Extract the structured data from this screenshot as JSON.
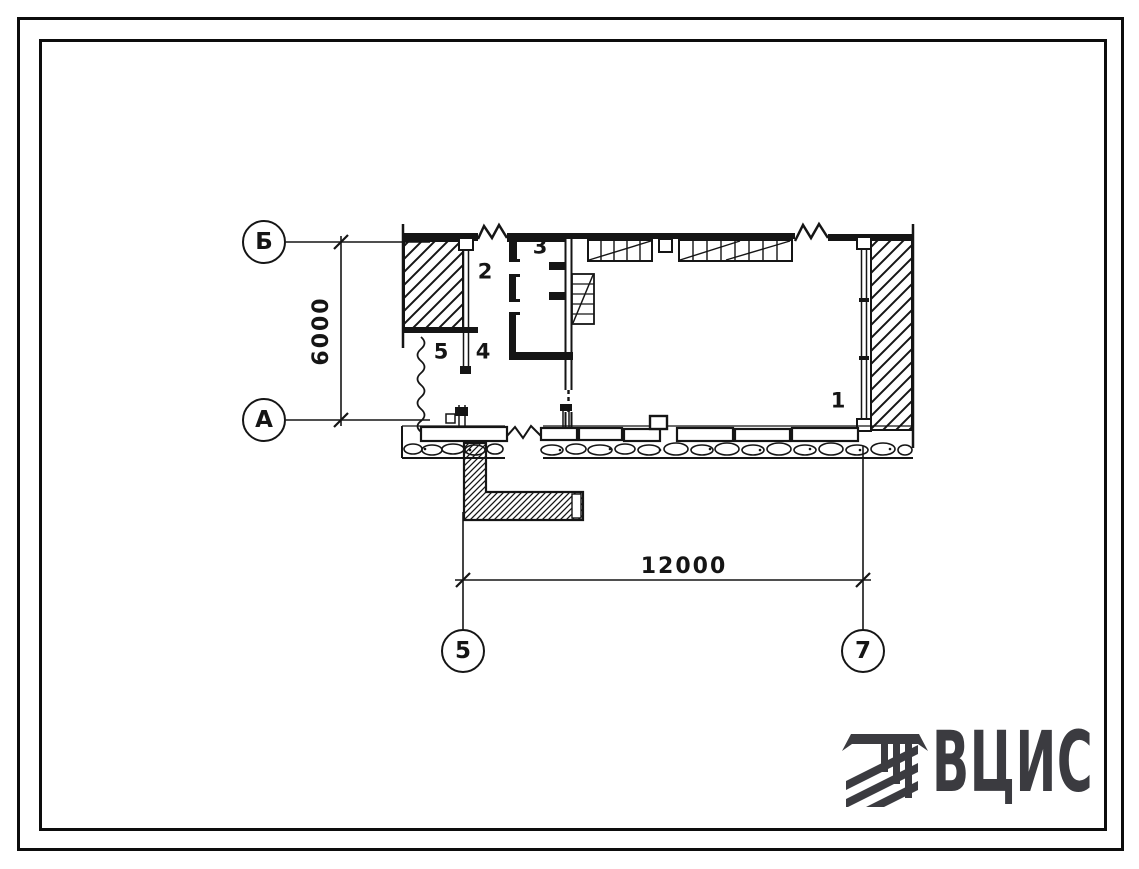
{
  "document": {
    "type": "architectural floor plan sheet",
    "sheet_number_visible": ""
  },
  "plan": {
    "axis_rows": [
      {
        "label": "Б"
      },
      {
        "label": "А"
      }
    ],
    "axis_cols": [
      {
        "label": "5"
      },
      {
        "label": "7"
      }
    ],
    "dim_vertical": "6000",
    "dim_horizontal": "12000",
    "part_labels": [
      "1",
      "2",
      "3",
      "4",
      "5"
    ]
  },
  "logo": {
    "text": "ВЦИС"
  },
  "colors": {
    "ink": "#151515",
    "frame": "#0d0d0d",
    "logo": "#3b3b40",
    "paper": "#ffffff"
  }
}
